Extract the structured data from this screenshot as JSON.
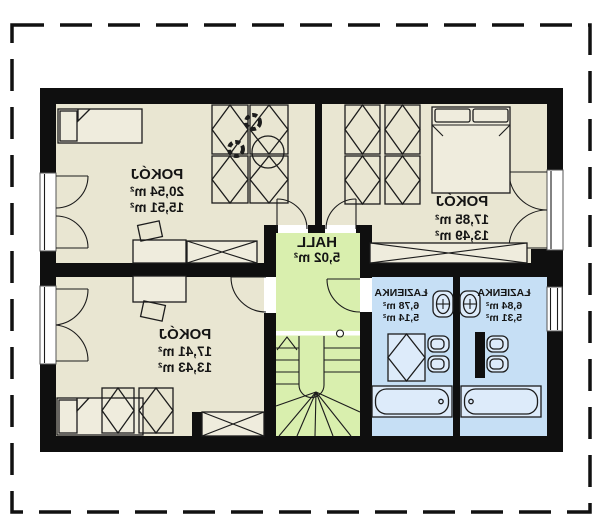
{
  "plan": {
    "mirrored_text": true,
    "colors": {
      "background": "#ffffff",
      "wall": "#0f0f0f",
      "room_floor": "#e9e6d2",
      "hall_floor": "#d9efae",
      "bath_floor": "#c6dff5",
      "furniture_fill": "#efecdd",
      "fixture_fill": "#ddebfa",
      "line": "#1c1c1c",
      "border": "#111111"
    },
    "rooms": {
      "top_left": {
        "name": "POKÓJ",
        "area_total": "20,54 m²",
        "area_net": "15,51 m²"
      },
      "top_right": {
        "name": "POKÓJ",
        "area_total": "17,85 m²",
        "area_net": "13,49 m²"
      },
      "bottom_left": {
        "name": "POKÓJ",
        "area_total": "17,41 m²",
        "area_net": "13,43 m²"
      },
      "hall": {
        "name": "HALL",
        "area_total": "5,02 m²"
      },
      "bathroom_left": {
        "name": "ŁAZIENKA",
        "area_total": "6,78 m²",
        "area_net": "5,14 m²"
      },
      "bathroom_right": {
        "name": "ŁAZIENKA",
        "area_total": "6,84 m²",
        "area_net": "5,31 m²"
      }
    }
  }
}
